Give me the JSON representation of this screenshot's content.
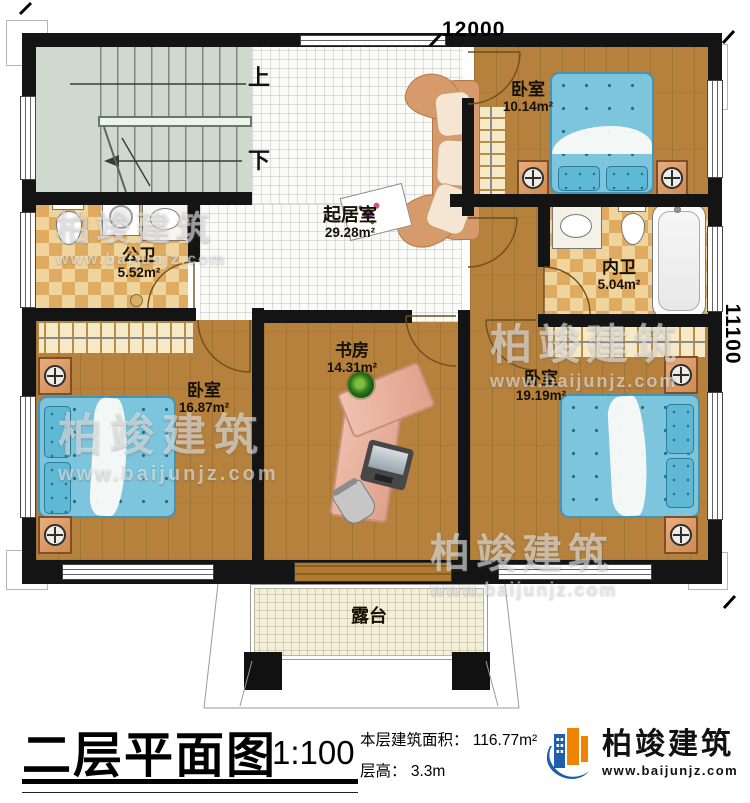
{
  "plan": {
    "dimensions": {
      "top": "12000",
      "right": "11100"
    },
    "stairs": {
      "up": "上",
      "down": "下"
    },
    "rooms": {
      "living": {
        "name": "起居室",
        "area": "29.28m²"
      },
      "bed_top": {
        "name": "卧室",
        "area": "10.14m²"
      },
      "bath_public": {
        "name": "公卫",
        "area": "5.52m²"
      },
      "bath_private": {
        "name": "内卫",
        "area": "5.04m²"
      },
      "bed_left": {
        "name": "卧室",
        "area": "16.87m²"
      },
      "study": {
        "name": "书房",
        "area": "14.31m²"
      },
      "bed_right": {
        "name": "卧室",
        "area": "19.19m²"
      },
      "terrace": {
        "name": "露台"
      }
    }
  },
  "watermark": {
    "brand": "柏竣建筑",
    "url": "www.baijunjz.com"
  },
  "titleblock": {
    "title": "二层平面图",
    "scale": "1:100",
    "area_label": "本层建筑面积：",
    "area_value": "116.77m²",
    "floor_height_label": "层高：",
    "floor_height_value": "3.3m",
    "brand": "柏竣建筑",
    "website": "www.baijunjz.com"
  },
  "colors": {
    "wall": "#141414",
    "wood_floor": "#b5813c",
    "bathroom_tile": "#dfab61",
    "bed_blue": "#7cc5dc",
    "brand_blue": "#1c5fae",
    "brand_orange": "#f08300"
  }
}
